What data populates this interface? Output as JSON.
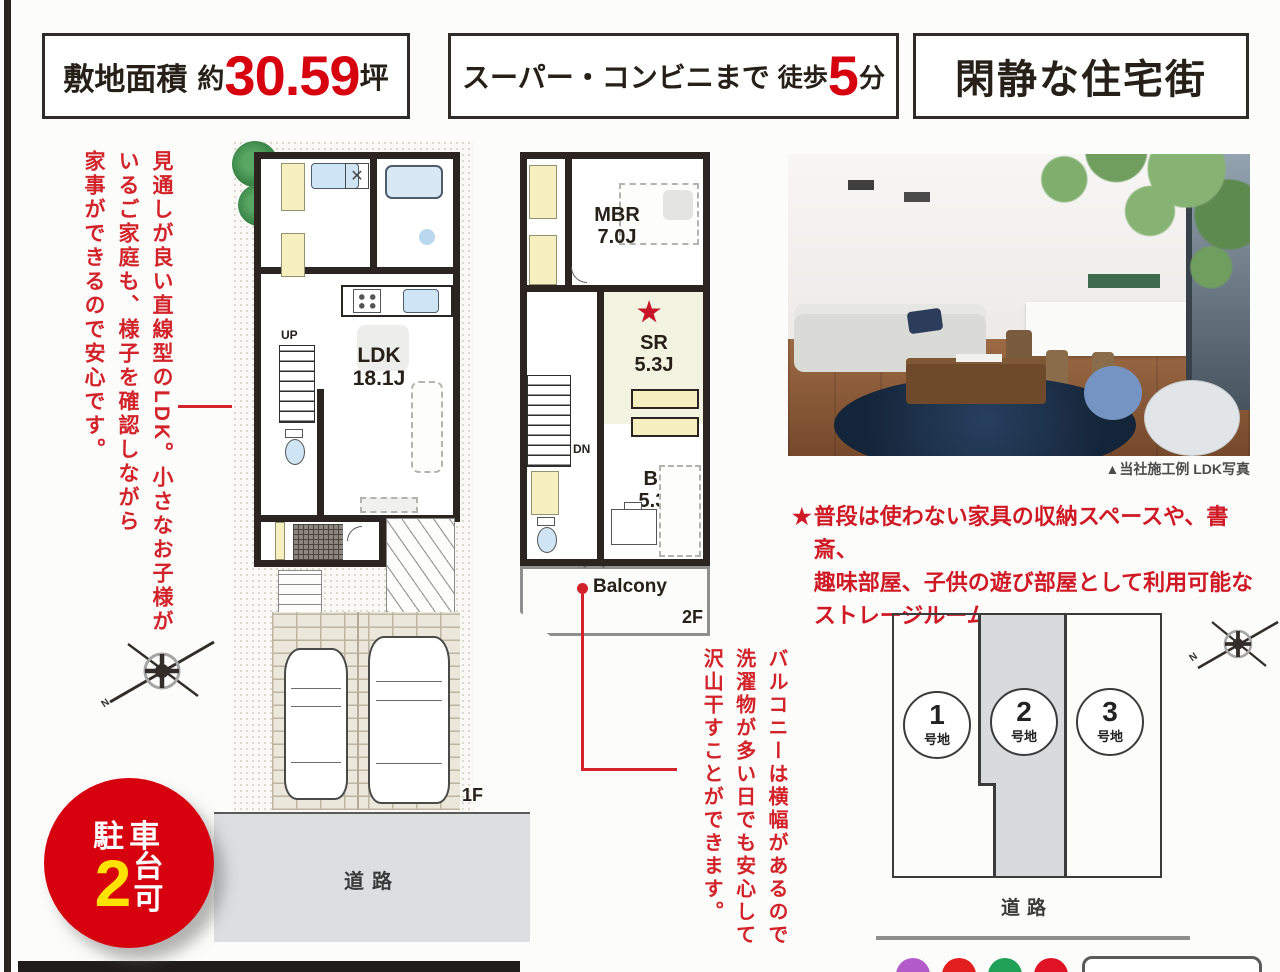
{
  "colors": {
    "red": "#d7000f",
    "note_red": "#d2232a",
    "yellow": "#ffe200"
  },
  "header": {
    "site_area": {
      "label": "敷地面積",
      "approx": "約",
      "value": "30.59",
      "unit": "坪"
    },
    "walk": {
      "label": "スーパー・コンビニまで",
      "prefix": "徒歩",
      "value": "5",
      "unit": "分"
    },
    "quiet": {
      "label": "閑静な住宅街"
    }
  },
  "notes": {
    "ldk": "見通しが良い直線型のLDK。小さなお子様が\nいるご家庭も、様子を確認しながら\n家事ができるので安心です。",
    "storage_star": "★",
    "storage": "普段は使わない家具の収納スペースや、書斎、\n趣味部屋、子供の遊び部屋として利用可能な\nストレージルーム。",
    "balcony": "バルコニーは横幅があるので\n洗濯物が多い日でも安心して\n沢山干すことができます。"
  },
  "badge": {
    "line1": "駐車",
    "number": "2",
    "unit": "台",
    "suffix": "可"
  },
  "plan1f": {
    "up": "UP",
    "ldk": "LDK",
    "ldk_size": "18.1J",
    "floor": "1F",
    "road": "道路"
  },
  "plan2f": {
    "mbr": "MBR",
    "mbr_size": "7.0J",
    "star": "★",
    "sr": "SR",
    "sr_size": "5.3J",
    "br": "BR",
    "br_size": "5.3J",
    "dn": "DN",
    "balcony": "Balcony",
    "floor": "2F"
  },
  "photo": {
    "caption": "▲当社施工例 LDK写真"
  },
  "siteplan": {
    "lots": [
      {
        "num": "1",
        "label": "号地"
      },
      {
        "num": "2",
        "label": "号地"
      },
      {
        "num": "3",
        "label": "号地"
      }
    ],
    "road": "道路",
    "compass_n": "N"
  }
}
